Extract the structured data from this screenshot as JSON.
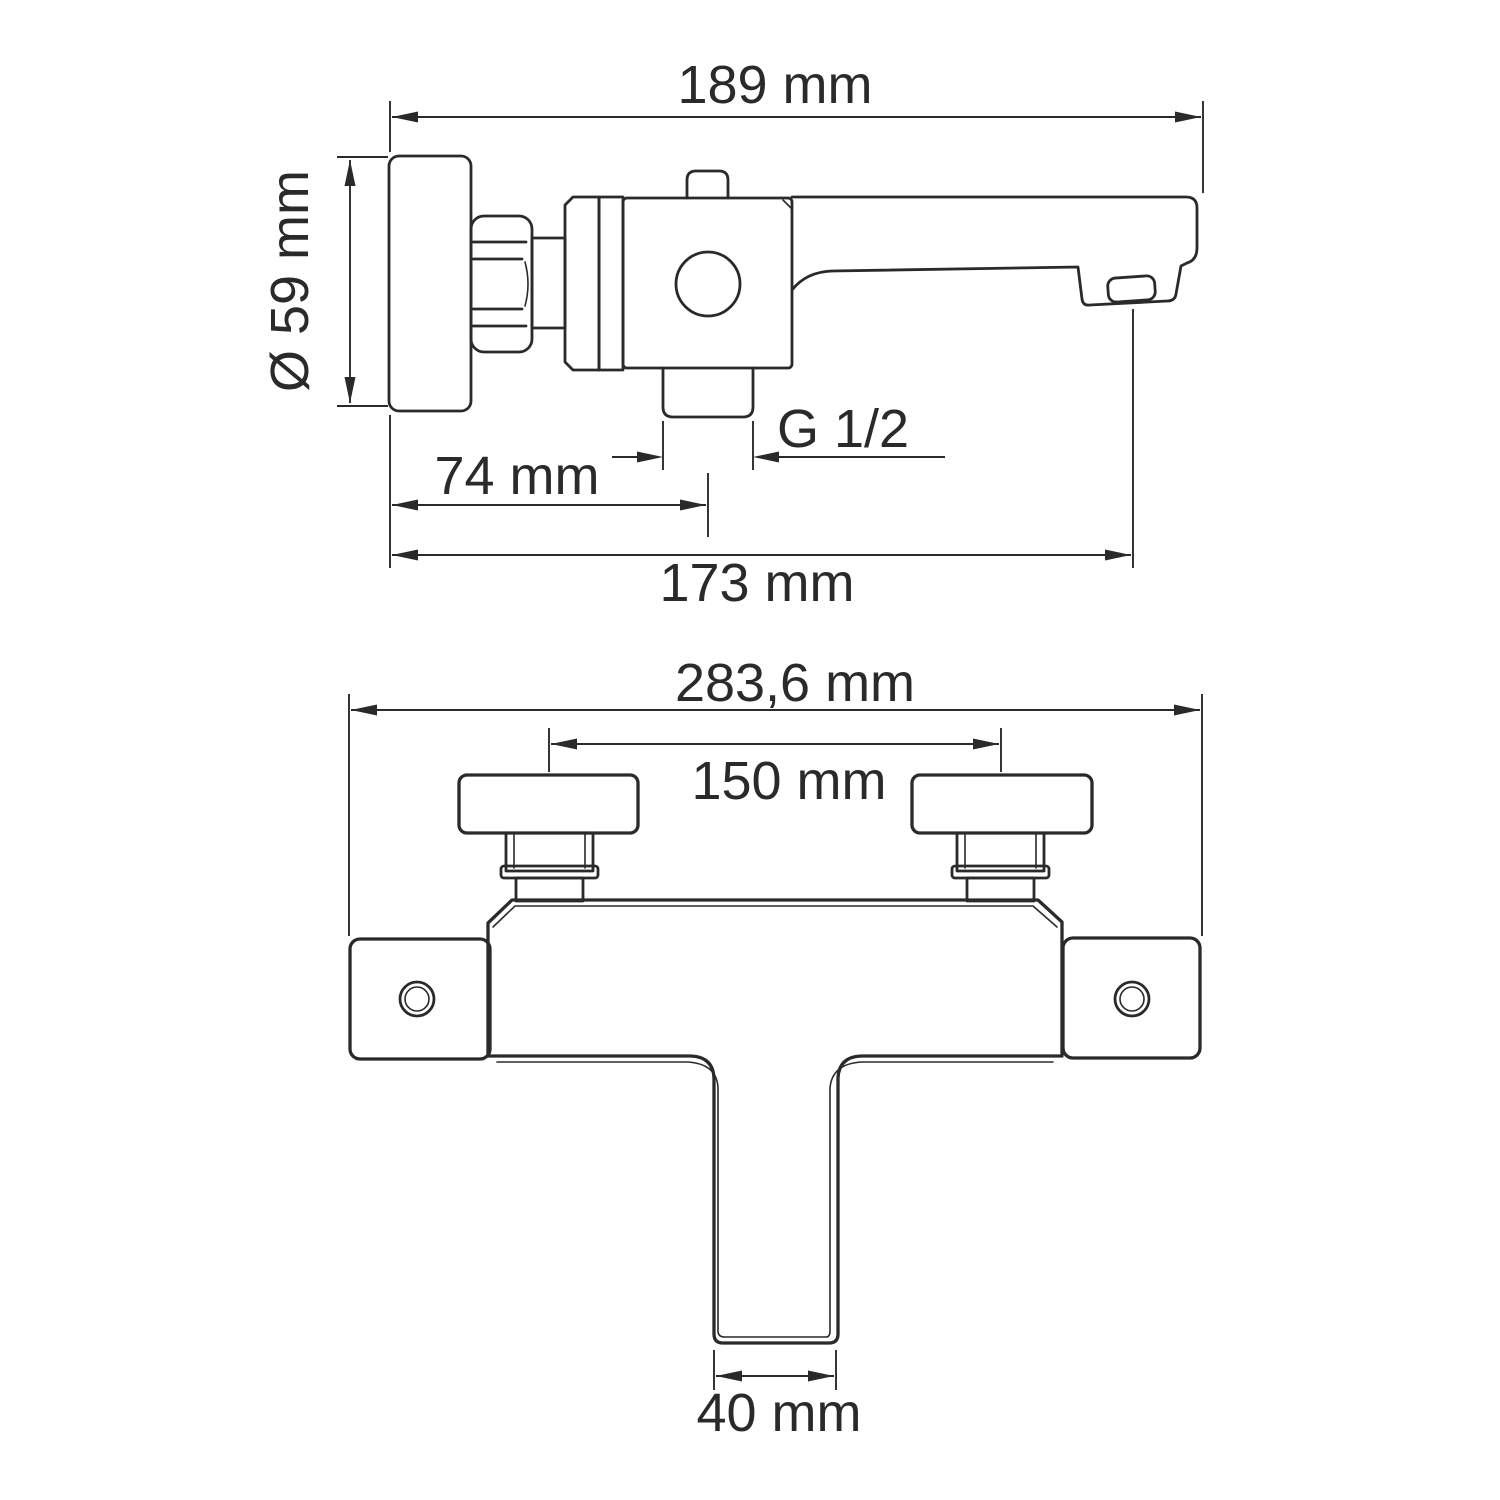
{
  "page": {
    "background": "#ffffff",
    "line_color": "#2b2a29"
  },
  "side_view": {
    "overall_width": "189 mm",
    "flange_diameter": "Ø 59 mm",
    "cartridge_offset": "74 mm",
    "spout_reach": "173 mm",
    "thread": "G 1/2"
  },
  "front_view": {
    "overall_width": "283,6 mm",
    "connection_centers": "150 mm",
    "spout_width": "40 mm"
  }
}
